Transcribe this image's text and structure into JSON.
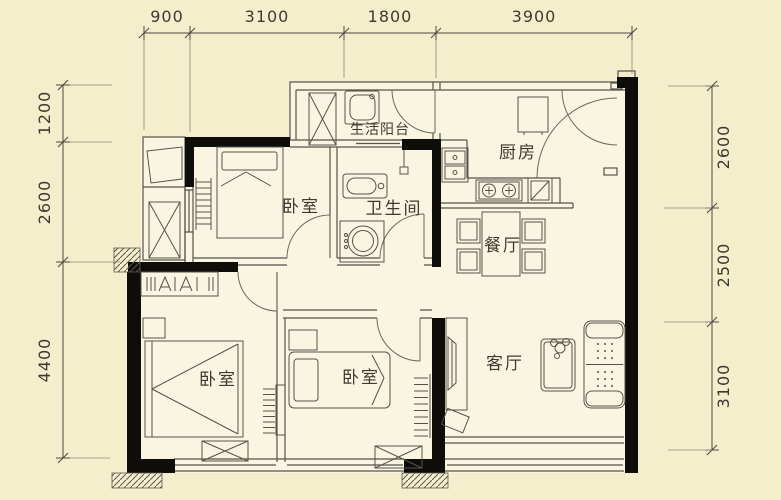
{
  "plan": {
    "type": "apartment-floor-plan",
    "dimensions_mm": {
      "top": [
        "900",
        "3100",
        "1800",
        "3900"
      ],
      "left": [
        "1200",
        "2600",
        "4400"
      ],
      "right": [
        "2600",
        "2500",
        "3100"
      ]
    },
    "rooms": {
      "service_balcony": "生活阳台",
      "kitchen": "厨房",
      "bedroom_top": "卧室",
      "bathroom": "卫生间",
      "dining_room": "餐厅",
      "living_room": "客厅",
      "bedroom_left": "卧室",
      "bedroom_middle": "卧室"
    },
    "colors": {
      "background": "#f5eecd",
      "room_fill": "#faf5e1",
      "wall": "#0e0d0a",
      "line": "#55534a",
      "line_light": "#8a887c",
      "text": "#3d3b31"
    }
  }
}
